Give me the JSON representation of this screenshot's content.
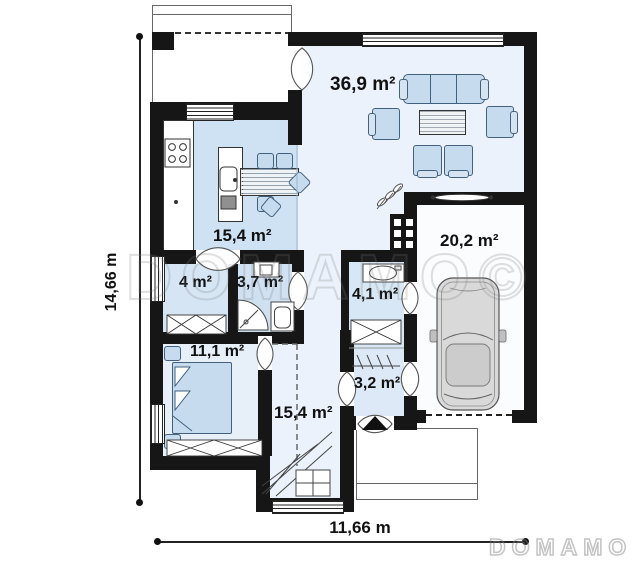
{
  "plan": {
    "watermark_center": "DOMAMO©",
    "watermark_logo": "DOMAMO",
    "dimension_height": "14,66 m",
    "dimension_width": "11,66 m"
  },
  "rooms": {
    "living": "36,9 m²",
    "kitchen": "15,4 m²",
    "garage": "20,2 m²",
    "pantry": "4 m²",
    "bathroom": "3,7 m²",
    "utility": "4,1 m²",
    "bedroom": "11,1 m²",
    "vestibule": "3,2 m²",
    "hall": "15,4 m²"
  },
  "colors": {
    "wall": "#161616",
    "floor_living_hall": "#ebf2fb",
    "floor_kitchen": "#cfe2f3",
    "floor_bath": "#cfe0f1",
    "floor_bedroom": "#e7eff9",
    "floor_garage": "#fafcfe",
    "furniture_fill": "#c6dbee",
    "furniture_stroke": "#41617f",
    "watermark_gray": "#8a8a8a"
  }
}
